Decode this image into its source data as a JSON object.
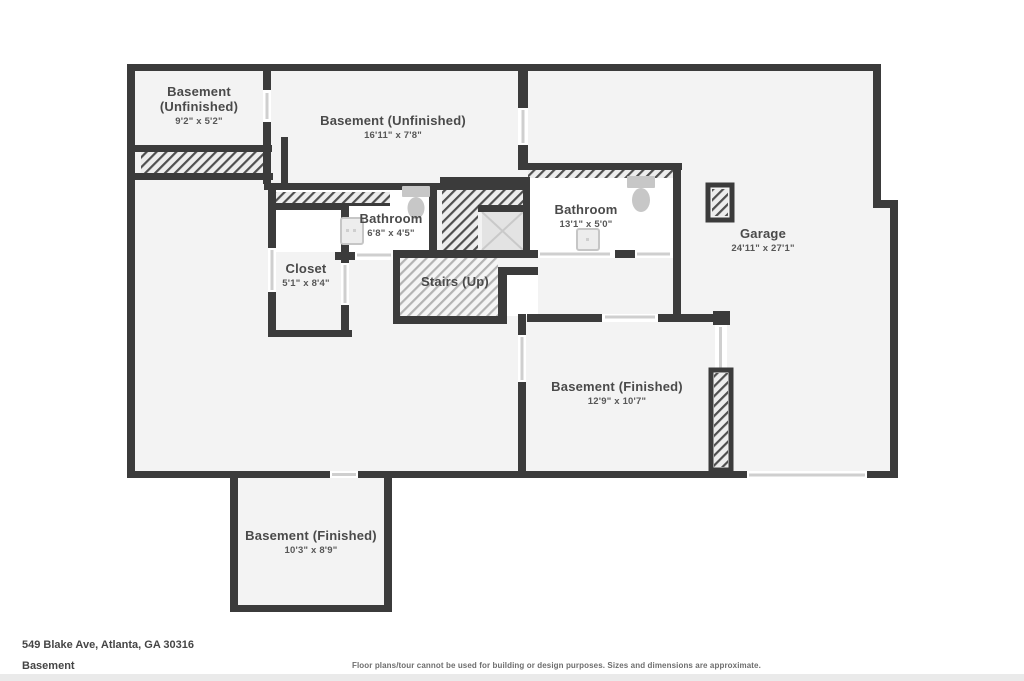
{
  "floor_plan": {
    "rooms": [
      {
        "name": "Basement (Unfinished)",
        "dims": "9'2\" x 5'2\""
      },
      {
        "name": "Basement (Unfinished)",
        "dims": "16'11\" x 7'8\""
      },
      {
        "name": "Bathroom",
        "dims": "6'8\" x 4'5\""
      },
      {
        "name": "Bathroom",
        "dims": "13'1\" x 5'0\""
      },
      {
        "name": "Garage",
        "dims": "24'11\" x 27'1\""
      },
      {
        "name": "Closet",
        "dims": "5'1\" x 8'4\""
      },
      {
        "name": "Stairs (Up)",
        "dims": ""
      },
      {
        "name": "Basement (Finished)",
        "dims": "12'9\" x 10'7\""
      },
      {
        "name": "Basement (Finished)",
        "dims": "10'3\" x 8'9\""
      }
    ],
    "fixtures": [
      "toilet",
      "toilet",
      "sink",
      "sink",
      "x-marker"
    ]
  },
  "footer": {
    "address": "549 Blake Ave, Atlanta, GA 30316",
    "floor_name": "Basement",
    "disclaimer": "Floor plans/tour cannot be used for building or design purposes. Sizes and dimensions are approximate."
  },
  "colors": {
    "wall": "#3b3b3b",
    "floor": "#f3f3f3",
    "bathroom_floor": "#ffffff",
    "hatch_dark": "#4f4f4f",
    "hatch_light": "#b3b3b3",
    "fixture": "#c7c7c7",
    "label_text": "#4a4a4a"
  }
}
